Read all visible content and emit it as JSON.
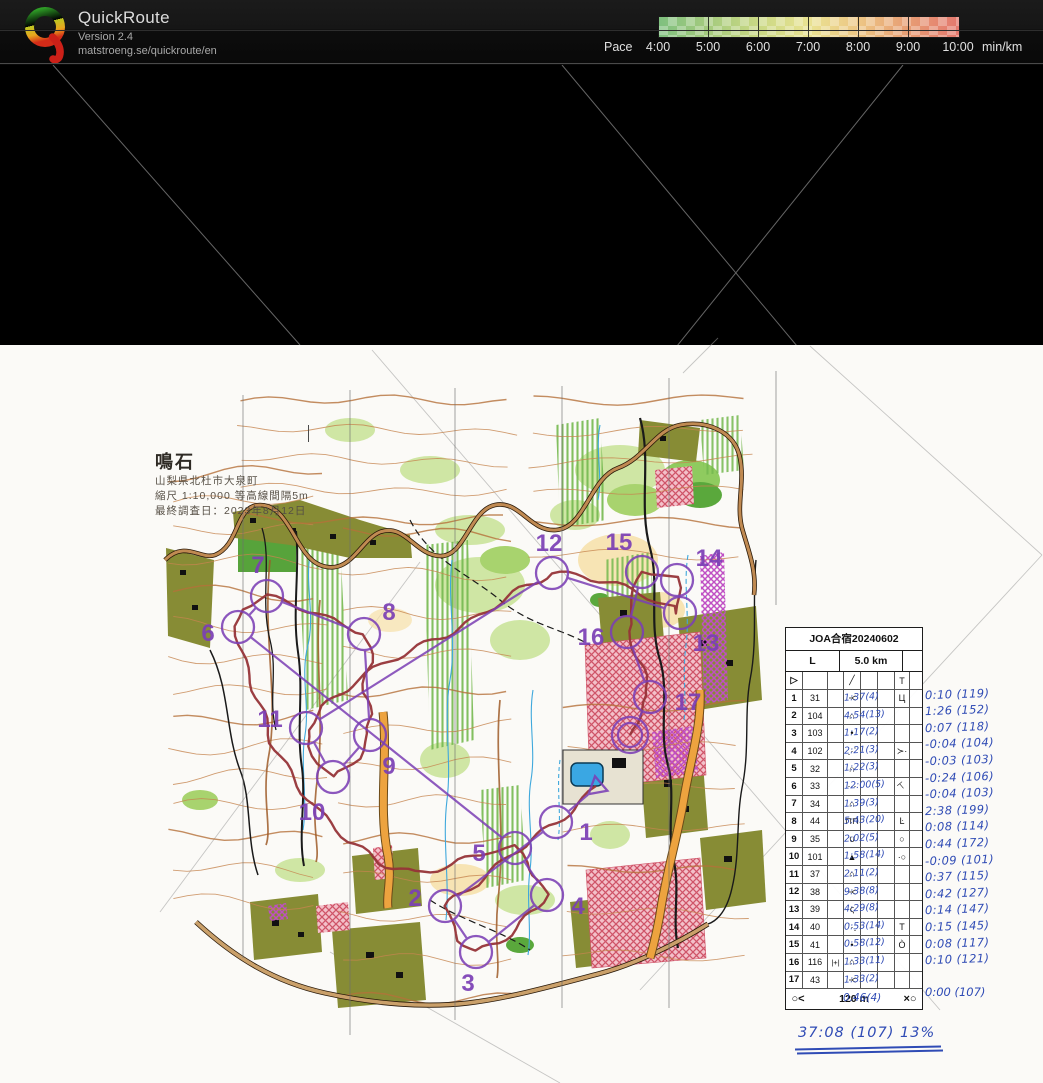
{
  "app": {
    "name": "QuickRoute",
    "version": "Version 2.4",
    "url": "matstroeng.se/quickroute/en"
  },
  "pace_legend": {
    "label": "Pace",
    "unit": "min/km",
    "ticks": [
      "4:00",
      "5:00",
      "6:00",
      "7:00",
      "8:00",
      "9:00",
      "10:00"
    ],
    "color_slow": "#e4786e",
    "color_fast": "#7fc07f"
  },
  "map_info": {
    "title": "鳴石",
    "lines": [
      "山梨県北杜市大泉町",
      "縮尺 1:10,000 等高線間隔5m",
      "最終調査日：2023年8月12日"
    ]
  },
  "colors": {
    "course_purple": "#7b3fb5",
    "track_red": "#963438",
    "ink_blue": "#2f4bb5"
  },
  "course": {
    "start": {
      "x": 597,
      "y": 787
    },
    "finish": {
      "x": 630,
      "y": 735
    },
    "controls": [
      {
        "n": "1",
        "x": 556,
        "y": 822,
        "dx": 30,
        "dy": 10
      },
      {
        "n": "2",
        "x": 445,
        "y": 906,
        "dx": -30,
        "dy": -8
      },
      {
        "n": "3",
        "x": 476,
        "y": 952,
        "dx": -8,
        "dy": 31
      },
      {
        "n": "4",
        "x": 547,
        "y": 895,
        "dx": 31,
        "dy": 11
      },
      {
        "n": "5",
        "x": 515,
        "y": 848,
        "dx": -36,
        "dy": 5
      },
      {
        "n": "6",
        "x": 238,
        "y": 627,
        "dx": -30,
        "dy": 6
      },
      {
        "n": "7",
        "x": 267,
        "y": 596,
        "dx": -9,
        "dy": -31
      },
      {
        "n": "8",
        "x": 364,
        "y": 634,
        "dx": 25,
        "dy": -22
      },
      {
        "n": "9",
        "x": 370,
        "y": 735,
        "dx": 19,
        "dy": 31
      },
      {
        "n": "10",
        "x": 333,
        "y": 777,
        "dx": -21,
        "dy": 35
      },
      {
        "n": "11",
        "x": 306,
        "y": 728,
        "dx": -36,
        "dy": -9
      },
      {
        "n": "12",
        "x": 552,
        "y": 573,
        "dx": -3,
        "dy": -30
      },
      {
        "n": "13",
        "x": 680,
        "y": 613,
        "dx": 26,
        "dy": 30
      },
      {
        "n": "14",
        "x": 677,
        "y": 580,
        "dx": 32,
        "dy": -22
      },
      {
        "n": "15",
        "x": 642,
        "y": 572,
        "dx": -23,
        "dy": -30
      },
      {
        "n": "16",
        "x": 627,
        "y": 632,
        "dx": -36,
        "dy": 5
      },
      {
        "n": "17",
        "x": 650,
        "y": 697,
        "dx": 38,
        "dy": 5
      }
    ]
  },
  "control_sheet": {
    "title": "JOA合宿20240602",
    "course_class": "L",
    "course_length": "5.0 km",
    "start_row": {
      "a": "▷",
      "d": "╱",
      "g": "T"
    },
    "finish_row": {
      "left": "○<",
      "center": "120 m",
      "right": "×○"
    },
    "rows": [
      {
        "no": "1",
        "code": "31",
        "c": "",
        "sym": "Y",
        "rot": "rot90",
        "time": "1:37(4)",
        "g": "Ц",
        "grot": "",
        "margin": "0:10 (119)"
      },
      {
        "no": "2",
        "code": "104",
        "c": "",
        "sym": "∩",
        "rot": "",
        "time": "4:54(13)",
        "g": "",
        "grot": "",
        "margin": "1:26 (152)"
      },
      {
        "no": "3",
        "code": "103",
        "c": "",
        "sym": "•",
        "rot": "",
        "time": "1:17(2)",
        "g": "",
        "grot": "",
        "margin": "0:07 (118)"
      },
      {
        "no": "4",
        "code": "102",
        "c": "",
        "sym": "⋰",
        "rot": "",
        "time": "2:21(3)",
        "g": "≻·",
        "grot": "",
        "margin": "-0:04 (104)"
      },
      {
        "no": "5",
        "code": "32",
        "c": "",
        "sym": "∩",
        "rot": "",
        "time": "1:22(3)",
        "g": "",
        "grot": "",
        "margin": "-0:03 (103)"
      },
      {
        "no": "6",
        "code": "33",
        "c": "",
        "sym": "⋯",
        "rot": "",
        "time": "12:00(5)",
        "g": "⊤",
        "grot": "rot-40",
        "margin": "-0:24 (106)"
      },
      {
        "no": "7",
        "code": "34",
        "c": "",
        "sym": "∩",
        "rot": "",
        "time": "1:39(3)",
        "g": "",
        "grot": "",
        "margin": "-0:04 (103)"
      },
      {
        "no": "8",
        "code": "44",
        "c": "",
        "sym": "⊓⊓",
        "rot": "",
        "time": "5:43(20)",
        "g": "Ŀ",
        "grot": "",
        "margin": "2:38 (199)"
      },
      {
        "no": "9",
        "code": "35",
        "c": "",
        "sym": "∪",
        "rot": "",
        "time": "2:02(5)",
        "g": "○",
        "grot": "",
        "margin": "0:08 (114)"
      },
      {
        "no": "10",
        "code": "101",
        "c": "",
        "sym": "▲",
        "rot": "",
        "time": "1:58(14)",
        "g": "·○",
        "grot": "",
        "margin": "0:44 (172)"
      },
      {
        "no": "11",
        "code": "37",
        "c": "",
        "sym": "∩",
        "rot": "",
        "time": "2:11(2)",
        "g": "",
        "grot": "",
        "margin": "-0:09 (101)"
      },
      {
        "no": "12",
        "code": "38",
        "c": "",
        "sym": "Y",
        "rot": "rot90",
        "time": "9:38(8)",
        "g": "",
        "grot": "",
        "margin": "0:37 (115)"
      },
      {
        "no": "13",
        "code": "39",
        "c": "",
        "sym": "ς",
        "rot": "",
        "time": "4:29(8)",
        "g": "",
        "grot": "",
        "margin": "0:42 (127)"
      },
      {
        "no": "14",
        "code": "40",
        "c": "",
        "sym": "⋱",
        "rot": "",
        "time": "0:53(14)",
        "g": "T",
        "grot": "",
        "margin": "0:14 (147)"
      },
      {
        "no": "15",
        "code": "41",
        "c": "",
        "sym": "•",
        "rot": "",
        "time": "0:58(12)",
        "g": "Ò",
        "grot": "",
        "margin": "0:15 (145)"
      },
      {
        "no": "16",
        "code": "116",
        "c": "|+|",
        "sym": "∩",
        "rot": "",
        "time": "1:33(11)",
        "g": "",
        "grot": "",
        "margin": "0:08 (117)"
      },
      {
        "no": "17",
        "code": "43",
        "c": "",
        "sym": "Y",
        "rot": "rot90",
        "time": "1:33(2)",
        "g": "",
        "grot": "",
        "margin": "0:10 (121)"
      }
    ],
    "below_sheet": "0.46(4)",
    "margin_total": "0:00 (107)",
    "summary": "37:08 (107)  13%"
  }
}
